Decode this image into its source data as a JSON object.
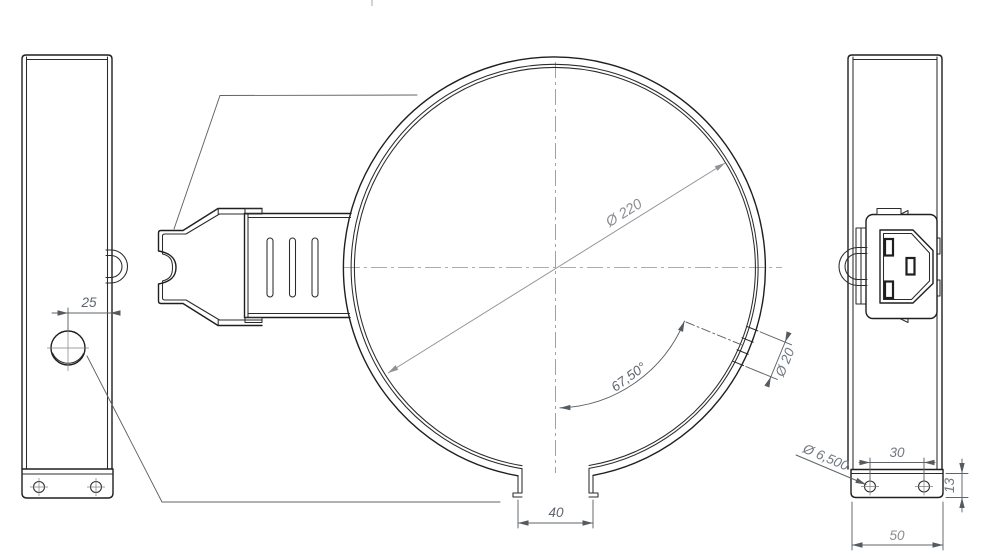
{
  "drawing": {
    "views": {
      "left_side_view": {
        "dims": {
          "bracket_offset": "25"
        }
      },
      "front_view": {
        "dims": {
          "ring_diameter": "Ø 220",
          "hole_angle": "67,50°",
          "hole_diameter": "Ø 20",
          "gap_width": "40"
        }
      },
      "right_side_view": {
        "dims": {
          "hole_spacing": "30",
          "mount_hole_diameter": "Ø 6,500",
          "foot_height": "13",
          "foot_width": "50"
        }
      }
    },
    "colors": {
      "outline": "#1f1f1f",
      "dimension": "#5d646e",
      "centerline": "#8e9196",
      "background": "#ffffff"
    }
  }
}
